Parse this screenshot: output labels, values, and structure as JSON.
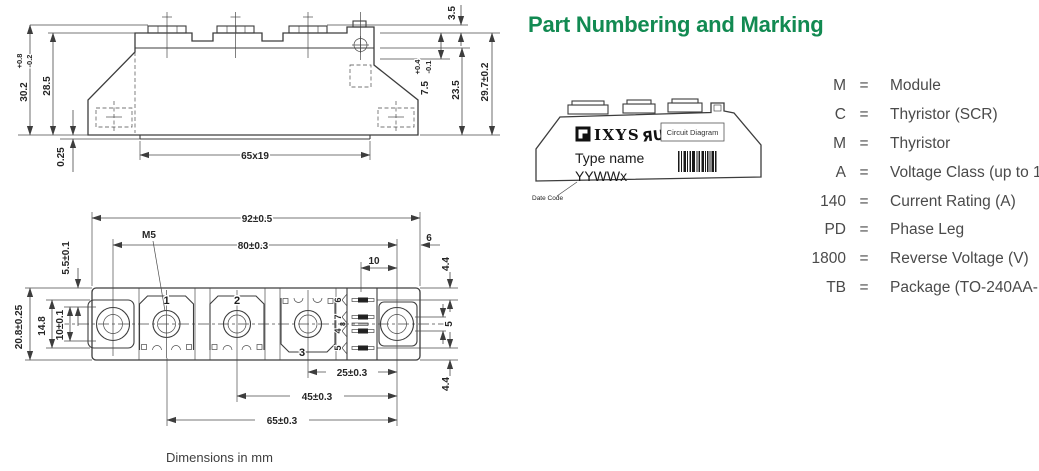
{
  "title": "Part Numbering and Marking",
  "caption": "Dimensions in mm",
  "colors": {
    "accent_green": "#128a52",
    "line": "#3d3d3d",
    "text": "#4a4a4a"
  },
  "side_view": {
    "height_overall": "30.2",
    "height_overall_tol_plus": "+0.8",
    "height_overall_tol_minus": "-0.2",
    "height_body": "28.5",
    "base_flatness": "0.25",
    "base_pad": "65x19",
    "pin_height": "3.5",
    "step_height": "7.5",
    "step_tol_plus": "+0.4",
    "step_tol_minus": "-0.1",
    "height_lower": "23.5",
    "height_total": "29.7±0.2"
  },
  "top_view": {
    "width_overall": "92±0.5",
    "hole_spacing": "80±0.3",
    "thread": "M5",
    "pin_to_hole": "10",
    "edge_to_hole": "6",
    "pin_offset_top": "4.4",
    "pin_pitch": "5",
    "pin_offset_bottom": "4.4",
    "edge_to_slot": "5.5±0.1",
    "depth_overall": "20.8±0.25",
    "pad_length": "14.8",
    "slot_length": "10±0.1",
    "t3_to_hole": "25±0.3",
    "t2_to_hole": "45±0.3",
    "t1_to_hole": "65±0.3",
    "terminals": [
      "1",
      "2",
      "3"
    ],
    "pins": [
      "6",
      "7",
      "8",
      "4",
      "5"
    ]
  },
  "module": {
    "brand": "IXYS",
    "ul_mark": "ЯU",
    "circuit_diagram": "Circuit Diagram",
    "type_name": "Type name",
    "date_code_value": "YYWWx",
    "date_code_label": "Date Code"
  },
  "legend": {
    "eq": "=",
    "rows": [
      {
        "key": "M",
        "value": "Module"
      },
      {
        "key": "C",
        "value": "Thyristor (SCR)"
      },
      {
        "key": "M",
        "value": "Thyristor"
      },
      {
        "key": "A",
        "value": "Voltage Class (up to 1800 V)"
      },
      {
        "key": "140",
        "value": "Current Rating (A)"
      },
      {
        "key": "PD",
        "value": "Phase Leg"
      },
      {
        "key": "1800",
        "value": "Reverse Voltage (V)"
      },
      {
        "key": "TB",
        "value": "Package (TO-240AA-1B)"
      }
    ]
  }
}
